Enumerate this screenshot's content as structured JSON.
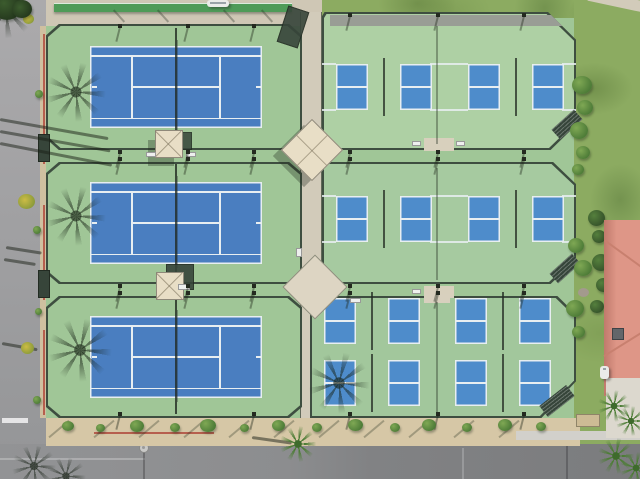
{
  "scene": {
    "title": "Aerial drone view of a tennis and pickleball court complex",
    "left_section": "3 blue tennis courts on green pads stacked vertically",
    "right_section": "8 blue pickleball courts on green pads in three rows (2 + 2 + 4)",
    "surroundings": [
      "asphalt road on left and bottom",
      "palm tree shadows",
      "grass lawn on right",
      "salmon tile roof building at lower right",
      "central concrete walkway with shade pavilions"
    ]
  },
  "colors": {
    "pad": "#a0c697",
    "padR1": "#aed0a4",
    "padR2": "#a6caa0",
    "padR3": "#a2c79c",
    "tblue": "#4a7ec0",
    "pblue": "#4e8ccb",
    "line": "#e8eef1",
    "fence": "#3e4e40",
    "road": "#a4a4a6",
    "roadDark": "#8c8d8f",
    "sand": "#d6c7a6",
    "grass": "#8cab61",
    "concrete": "#d2cbba",
    "canopy": "#e8dec6",
    "roof": "#de9687",
    "curbRed": "#b65f4e"
  },
  "courts": {
    "tennis": {
      "count": 3,
      "w": 172,
      "h": 82,
      "items": [
        {
          "x": 90,
          "y": 46
        },
        {
          "x": 90,
          "y": 182
        },
        {
          "x": 90,
          "y": 316
        }
      ]
    },
    "pickleball": {
      "count": 8,
      "half_w": 32,
      "half_h": 46,
      "kitchen": 32,
      "items": [
        {
          "x": 336,
          "y": 64
        },
        {
          "x": 468,
          "y": 64
        },
        {
          "x": 336,
          "y": 196
        },
        {
          "x": 468,
          "y": 196
        },
        {
          "x": 324,
          "y": 298
        },
        {
          "x": 455,
          "y": 298
        },
        {
          "x": 324,
          "y": 360
        },
        {
          "x": 455,
          "y": 360
        }
      ]
    }
  }
}
